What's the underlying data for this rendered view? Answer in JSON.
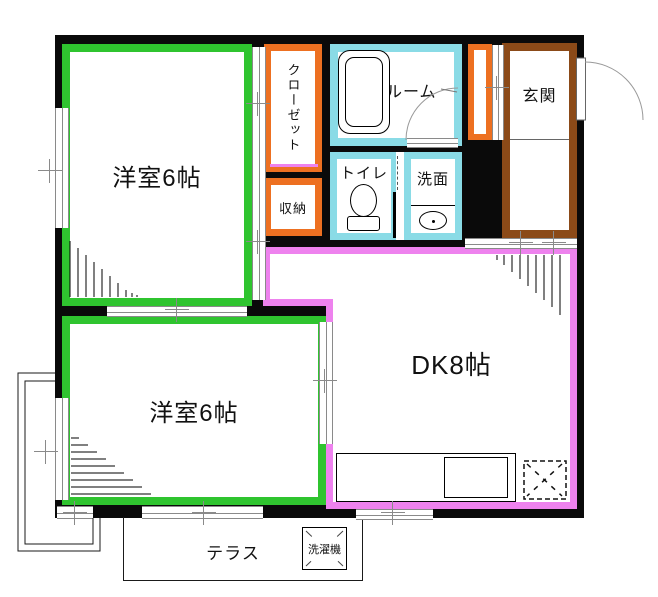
{
  "colors": {
    "wall": "#0a0a0a",
    "green": "#2fc42f",
    "orange": "#ed7021",
    "cyan": "#8adbe6",
    "brown": "#8b4a18",
    "pink": "#ee82ee",
    "gray": "#8a8a8a"
  },
  "rooms": {
    "western1": {
      "label": "洋室6帖"
    },
    "western2": {
      "label": "洋室6帖"
    },
    "dining_kitchen": {
      "label": "DK8帖"
    },
    "closet": {
      "label": "クローゼット"
    },
    "storage": {
      "label": "収納"
    },
    "bathroom": {
      "label": "バスルーム"
    },
    "toilet": {
      "label": "トイレ"
    },
    "washroom": {
      "label": "洗面"
    },
    "entrance": {
      "label": "玄関"
    },
    "terrace": {
      "label": "テラス"
    },
    "washing_machine": {
      "label": "洗濯機"
    }
  }
}
